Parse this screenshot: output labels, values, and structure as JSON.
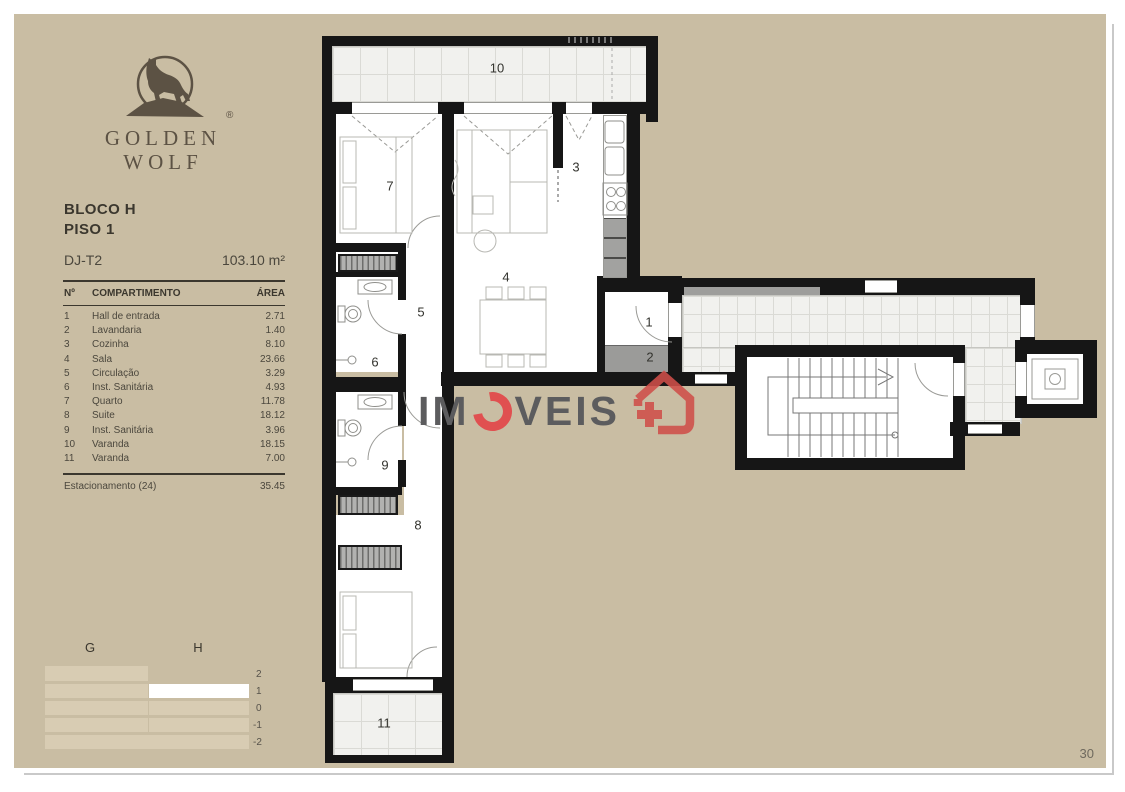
{
  "brand": {
    "line1": "GOLDEN",
    "line2": "WOLF",
    "registered": "®",
    "logo_icon": "wolf-on-rock-icon"
  },
  "header": {
    "block": "BLOCO H",
    "floor": "PISO 1",
    "unit": "DJ-T2",
    "total_area": "103.10 m²"
  },
  "table": {
    "col_no": "Nº",
    "col_name": "COMPARTIMENTO",
    "col_area": "ÁREA",
    "rows": [
      {
        "no": "1",
        "name": "Hall de entrada",
        "area": "2.71"
      },
      {
        "no": "2",
        "name": "Lavandaria",
        "area": "1.40"
      },
      {
        "no": "3",
        "name": "Cozinha",
        "area": "8.10"
      },
      {
        "no": "4",
        "name": "Sala",
        "area": "23.66"
      },
      {
        "no": "5",
        "name": "Circulação",
        "area": "3.29"
      },
      {
        "no": "6",
        "name": "Inst. Sanitária",
        "area": "4.93"
      },
      {
        "no": "7",
        "name": "Quarto",
        "area": "11.78"
      },
      {
        "no": "8",
        "name": "Suite",
        "area": "18.12"
      },
      {
        "no": "9",
        "name": "Inst. Sanitária",
        "area": "3.96"
      },
      {
        "no": "10",
        "name": "Varanda",
        "area": "18.15"
      },
      {
        "no": "11",
        "name": "Varanda",
        "area": "7.00"
      }
    ],
    "footer": {
      "name": "Estacionamento (24)",
      "area": "35.45"
    }
  },
  "section_diagram": {
    "block_left": "G",
    "block_right": "H",
    "levels": [
      "2",
      "1",
      "0",
      "-1",
      "-2"
    ],
    "highlight_block": "H",
    "highlight_level": "1"
  },
  "plan": {
    "rooms": [
      "1",
      "2",
      "3",
      "4",
      "5",
      "6",
      "7",
      "8",
      "9",
      "10",
      "11"
    ]
  },
  "watermark": {
    "prefix": "IM",
    "suffix": "VEIS",
    "icon": "house-plus-icon"
  },
  "page": {
    "number": "30"
  },
  "colors": {
    "page_bg": "#c9bda3",
    "wall": "#161616",
    "tile": "#f1f1ee",
    "bar_light": "#d8ccb3",
    "watermark_red": "#e05050",
    "watermark_gray": "#5c5c5e",
    "brand_brown": "#5c5244",
    "text_dark": "#3b372e",
    "text": "#4b473d"
  }
}
